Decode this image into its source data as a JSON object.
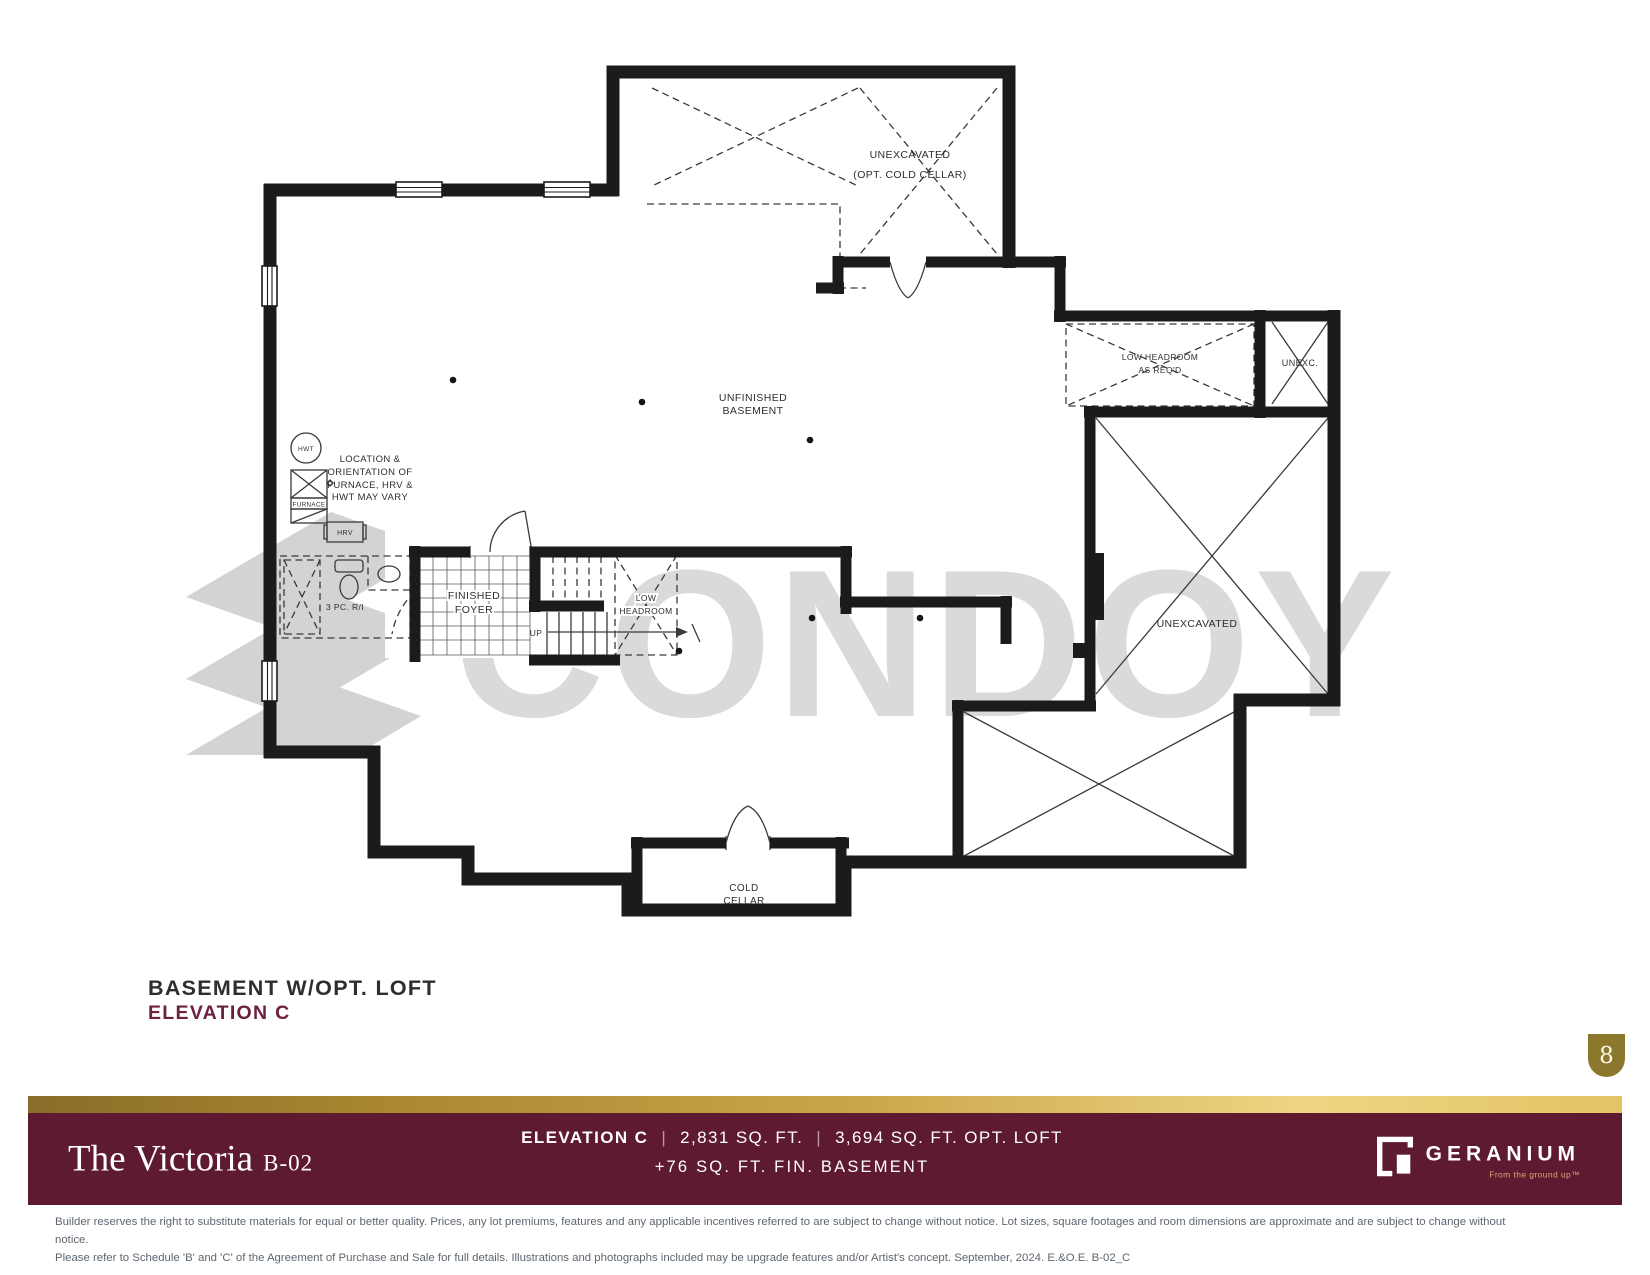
{
  "watermark": {
    "text": "CONDOY"
  },
  "plan": {
    "unexcavated_top_1": "UNEXCAVATED",
    "unexcavated_top_2": "(OPT. COLD CELLAR)",
    "low_headroom_req_1": "LOW HEADROOM",
    "low_headroom_req_2": "AS REQ'D",
    "unexc": "UNEXC.",
    "unfinished_1": "UNFINISHED",
    "unfinished_2": "BASEMENT",
    "unexcavated_right": "UNEXCAVATED",
    "low_headroom_1": "LOW",
    "low_headroom_2": "HEADROOM",
    "finished_foyer_1": "FINISHED",
    "finished_foyer_2": "FOYER",
    "cold_cellar_1": "COLD",
    "cold_cellar_2": "CELLAR",
    "bath_ri": "3 PC. R/I",
    "up": "UP",
    "hwt": "HWT",
    "furnace": "FURNACE",
    "hrv": "HRV",
    "note": [
      "LOCATION &",
      "ORIENTATION OF",
      "FURNACE, HRV &",
      "HWT MAY VARY"
    ]
  },
  "titles": {
    "plan_title": "BASEMENT W/OPT. LOFT",
    "elevation": "ELEVATION C",
    "page": "8"
  },
  "footer": {
    "model_name": "The Victoria",
    "model_code": "B-02",
    "elevation_label": "ELEVATION C",
    "separator": "|",
    "sqft": "2,831 SQ. FT.",
    "sqft_loft": "3,694 SQ. FT. OPT. LOFT",
    "basement_line": "+76 SQ. FT. FIN. BASEMENT",
    "brand": "GERANIUM",
    "brand_tagline": "From the ground up™",
    "colors": {
      "maroon": "#5E1A31",
      "gold": "#B3913F",
      "title_maroon": "#6B2140",
      "badge_gold": "#8C782D"
    }
  },
  "disclaimer": [
    "Builder reserves the right to substitute materials for equal or better quality. Prices, any lot premiums, features and any applicable incentives referred to are subject to change without notice. Lot sizes, square footages and room dimensions are approximate and are subject to change without notice.",
    "Please refer to Schedule 'B' and 'C' of the Agreement of Purchase and Sale for full details. Illustrations and photographs included may be upgrade features and/or Artist's concept. September, 2024. E.&O.E. B-02_C"
  ]
}
